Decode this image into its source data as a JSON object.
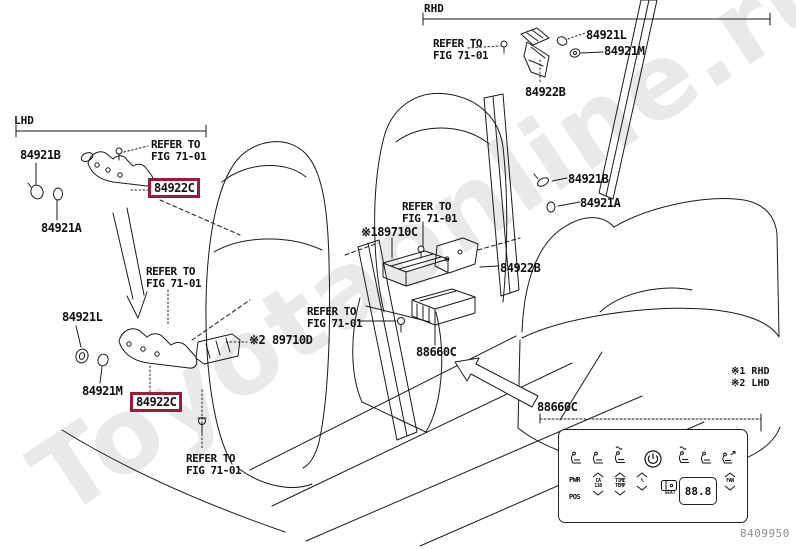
{
  "watermark": "Toyotaonline.ru",
  "diagram_code": "8409950",
  "sections": {
    "rhd": "RHD",
    "lhd": "LHD"
  },
  "refer_note": {
    "line1": "REFER TO",
    "line2": "FIG 71-01"
  },
  "footnotes": {
    "note1": "※1 RHD",
    "note2": "※2 LHD"
  },
  "part_labels": [
    {
      "id": "84921L-top",
      "text": "84921L",
      "x": 586,
      "y": 28,
      "boxed": false
    },
    {
      "id": "84921M-top",
      "text": "84921M",
      "x": 604,
      "y": 44,
      "boxed": false
    },
    {
      "id": "84922B-top",
      "text": "84922B",
      "x": 525,
      "y": 85,
      "boxed": false
    },
    {
      "id": "84921B-left",
      "text": "84921B",
      "x": 20,
      "y": 148,
      "boxed": false
    },
    {
      "id": "84922C-left",
      "text": "84922C",
      "x": 154,
      "y": 182,
      "boxed": true
    },
    {
      "id": "84921A-left",
      "text": "84921A",
      "x": 41,
      "y": 221,
      "boxed": false
    },
    {
      "id": "84921L-mid",
      "text": "84921L",
      "x": 62,
      "y": 310,
      "boxed": false
    },
    {
      "id": "84921M-mid",
      "text": "84921M",
      "x": 82,
      "y": 384,
      "boxed": false
    },
    {
      "id": "84922C-mid",
      "text": "84922C",
      "x": 136,
      "y": 396,
      "boxed": true
    },
    {
      "id": "89710D",
      "text": "※2 89710D",
      "x": 249,
      "y": 333,
      "boxed": false
    },
    {
      "id": "89710C",
      "text": "※189710C",
      "x": 361,
      "y": 225,
      "boxed": false
    },
    {
      "id": "84922B-mid",
      "text": "84922B",
      "x": 500,
      "y": 261,
      "boxed": false
    },
    {
      "id": "84921B-right",
      "text": "84921B",
      "x": 568,
      "y": 172,
      "boxed": false
    },
    {
      "id": "84921A-right",
      "text": "84921A",
      "x": 580,
      "y": 196,
      "boxed": false
    },
    {
      "id": "88660C-center",
      "text": "88660C",
      "x": 416,
      "y": 345,
      "boxed": false
    },
    {
      "id": "88660C-panel",
      "text": "88660C",
      "x": 537,
      "y": 400,
      "boxed": false
    }
  ],
  "refer_note_positions": [
    {
      "x": 433,
      "y": 38
    },
    {
      "x": 151,
      "y": 139
    },
    {
      "x": 146,
      "y": 266
    },
    {
      "x": 186,
      "y": 453
    },
    {
      "x": 307,
      "y": 306
    },
    {
      "x": 402,
      "y": 201
    }
  ],
  "panel": {
    "pwr": "PWR",
    "pos": "POS",
    "col1_line1": "CA",
    "col1_line2": "110",
    "col2_line1": "TIME",
    "col2_line2": "TEMP",
    "col3": "%",
    "seat_btn": "SEAT",
    "display": "88.8",
    "fan": "FAN"
  },
  "colors": {
    "highlight_box": "#9b1b3c",
    "line_art": "#1a1a1a",
    "code_text": "#8f8f8f"
  }
}
